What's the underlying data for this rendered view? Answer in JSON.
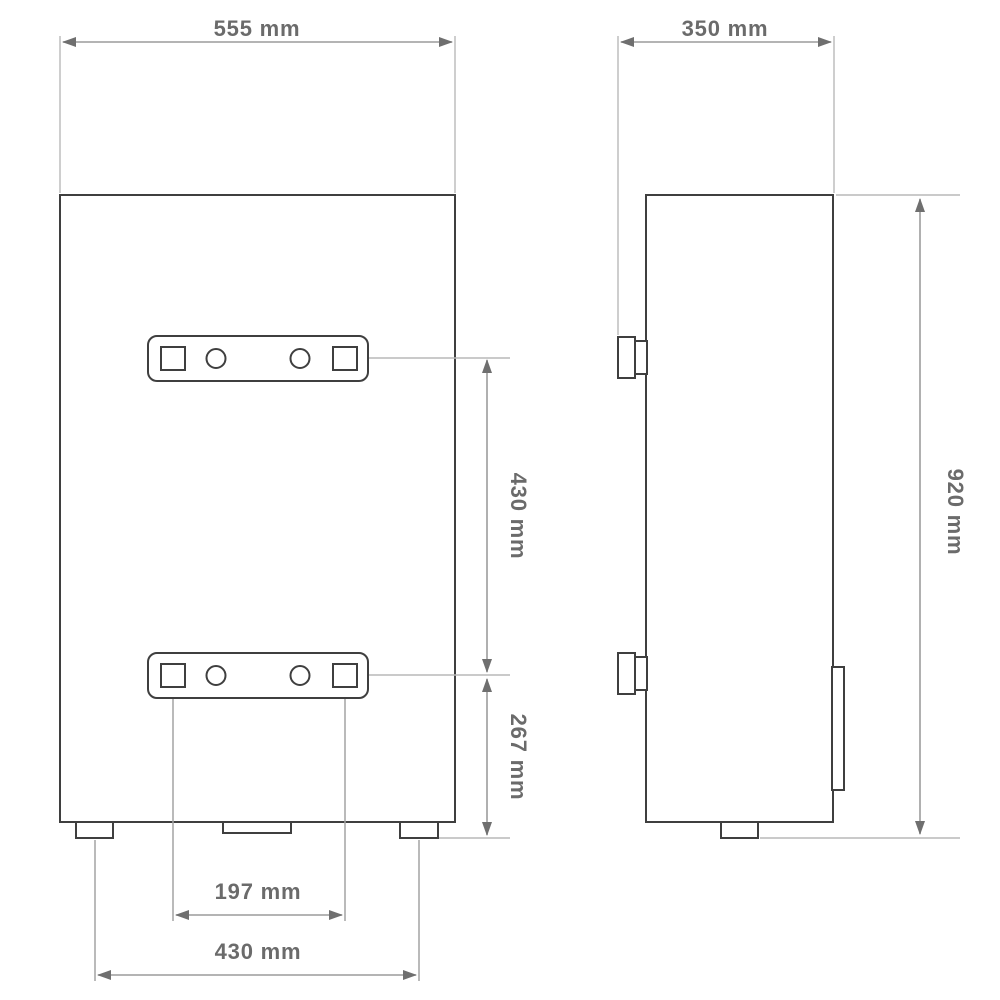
{
  "drawing": {
    "description": "Technical dimension drawing of wall-mounted appliance, front view and side view",
    "views": {
      "front": "front-view",
      "side": "side-view"
    }
  },
  "dimensions": {
    "front_width": {
      "label": "555 mm",
      "value_mm": 555
    },
    "depth": {
      "label": "350 mm",
      "value_mm": 350
    },
    "bracket_spacing_v": {
      "label": "430 mm",
      "value_mm": 430
    },
    "bracket_to_bottom": {
      "label": "267 mm",
      "value_mm": 267
    },
    "hole_spacing": {
      "label": "197 mm",
      "value_mm": 197
    },
    "feet_spacing": {
      "label": "430 mm",
      "value_mm": 430
    },
    "height": {
      "label": "920 mm",
      "value_mm": 920
    }
  },
  "colors": {
    "background": "#ffffff",
    "outline": "#3f3f3f",
    "dimension_line": "#9c9c9c",
    "extension_line": "#b9b9b9",
    "arrowhead": "#6f6f6f",
    "label_text": "#6b6b6b"
  }
}
